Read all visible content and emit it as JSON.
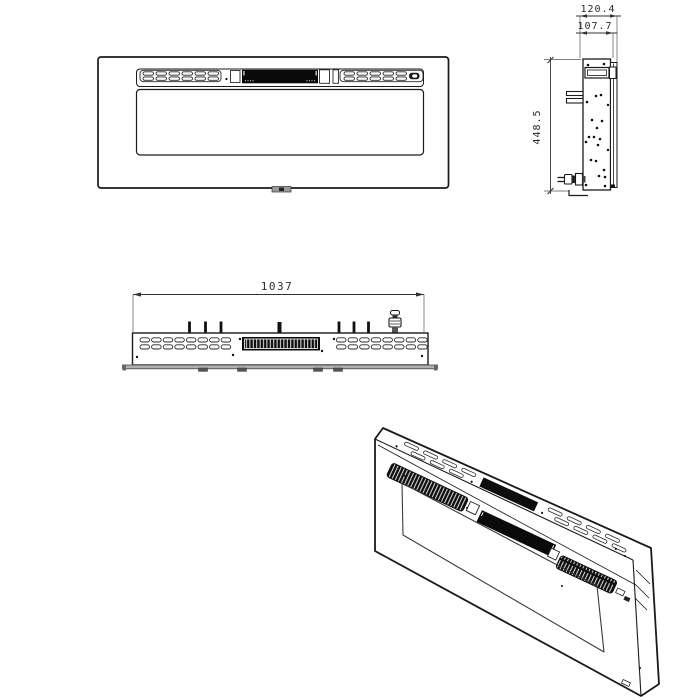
{
  "colors": {
    "line": "#1a1a1a",
    "display_fill": "#0a0a0a",
    "metal_gray": "#9a9a9a",
    "background": "#ffffff"
  },
  "views": {
    "front": {
      "label": "front-view"
    },
    "side": {
      "label": "side-view",
      "dims": {
        "depth_overall": "120.4",
        "depth_body": "107.7",
        "height": "448.5"
      }
    },
    "top": {
      "label": "top-view",
      "dims": {
        "width": "1037"
      }
    },
    "iso": {
      "label": "isometric-view"
    }
  }
}
